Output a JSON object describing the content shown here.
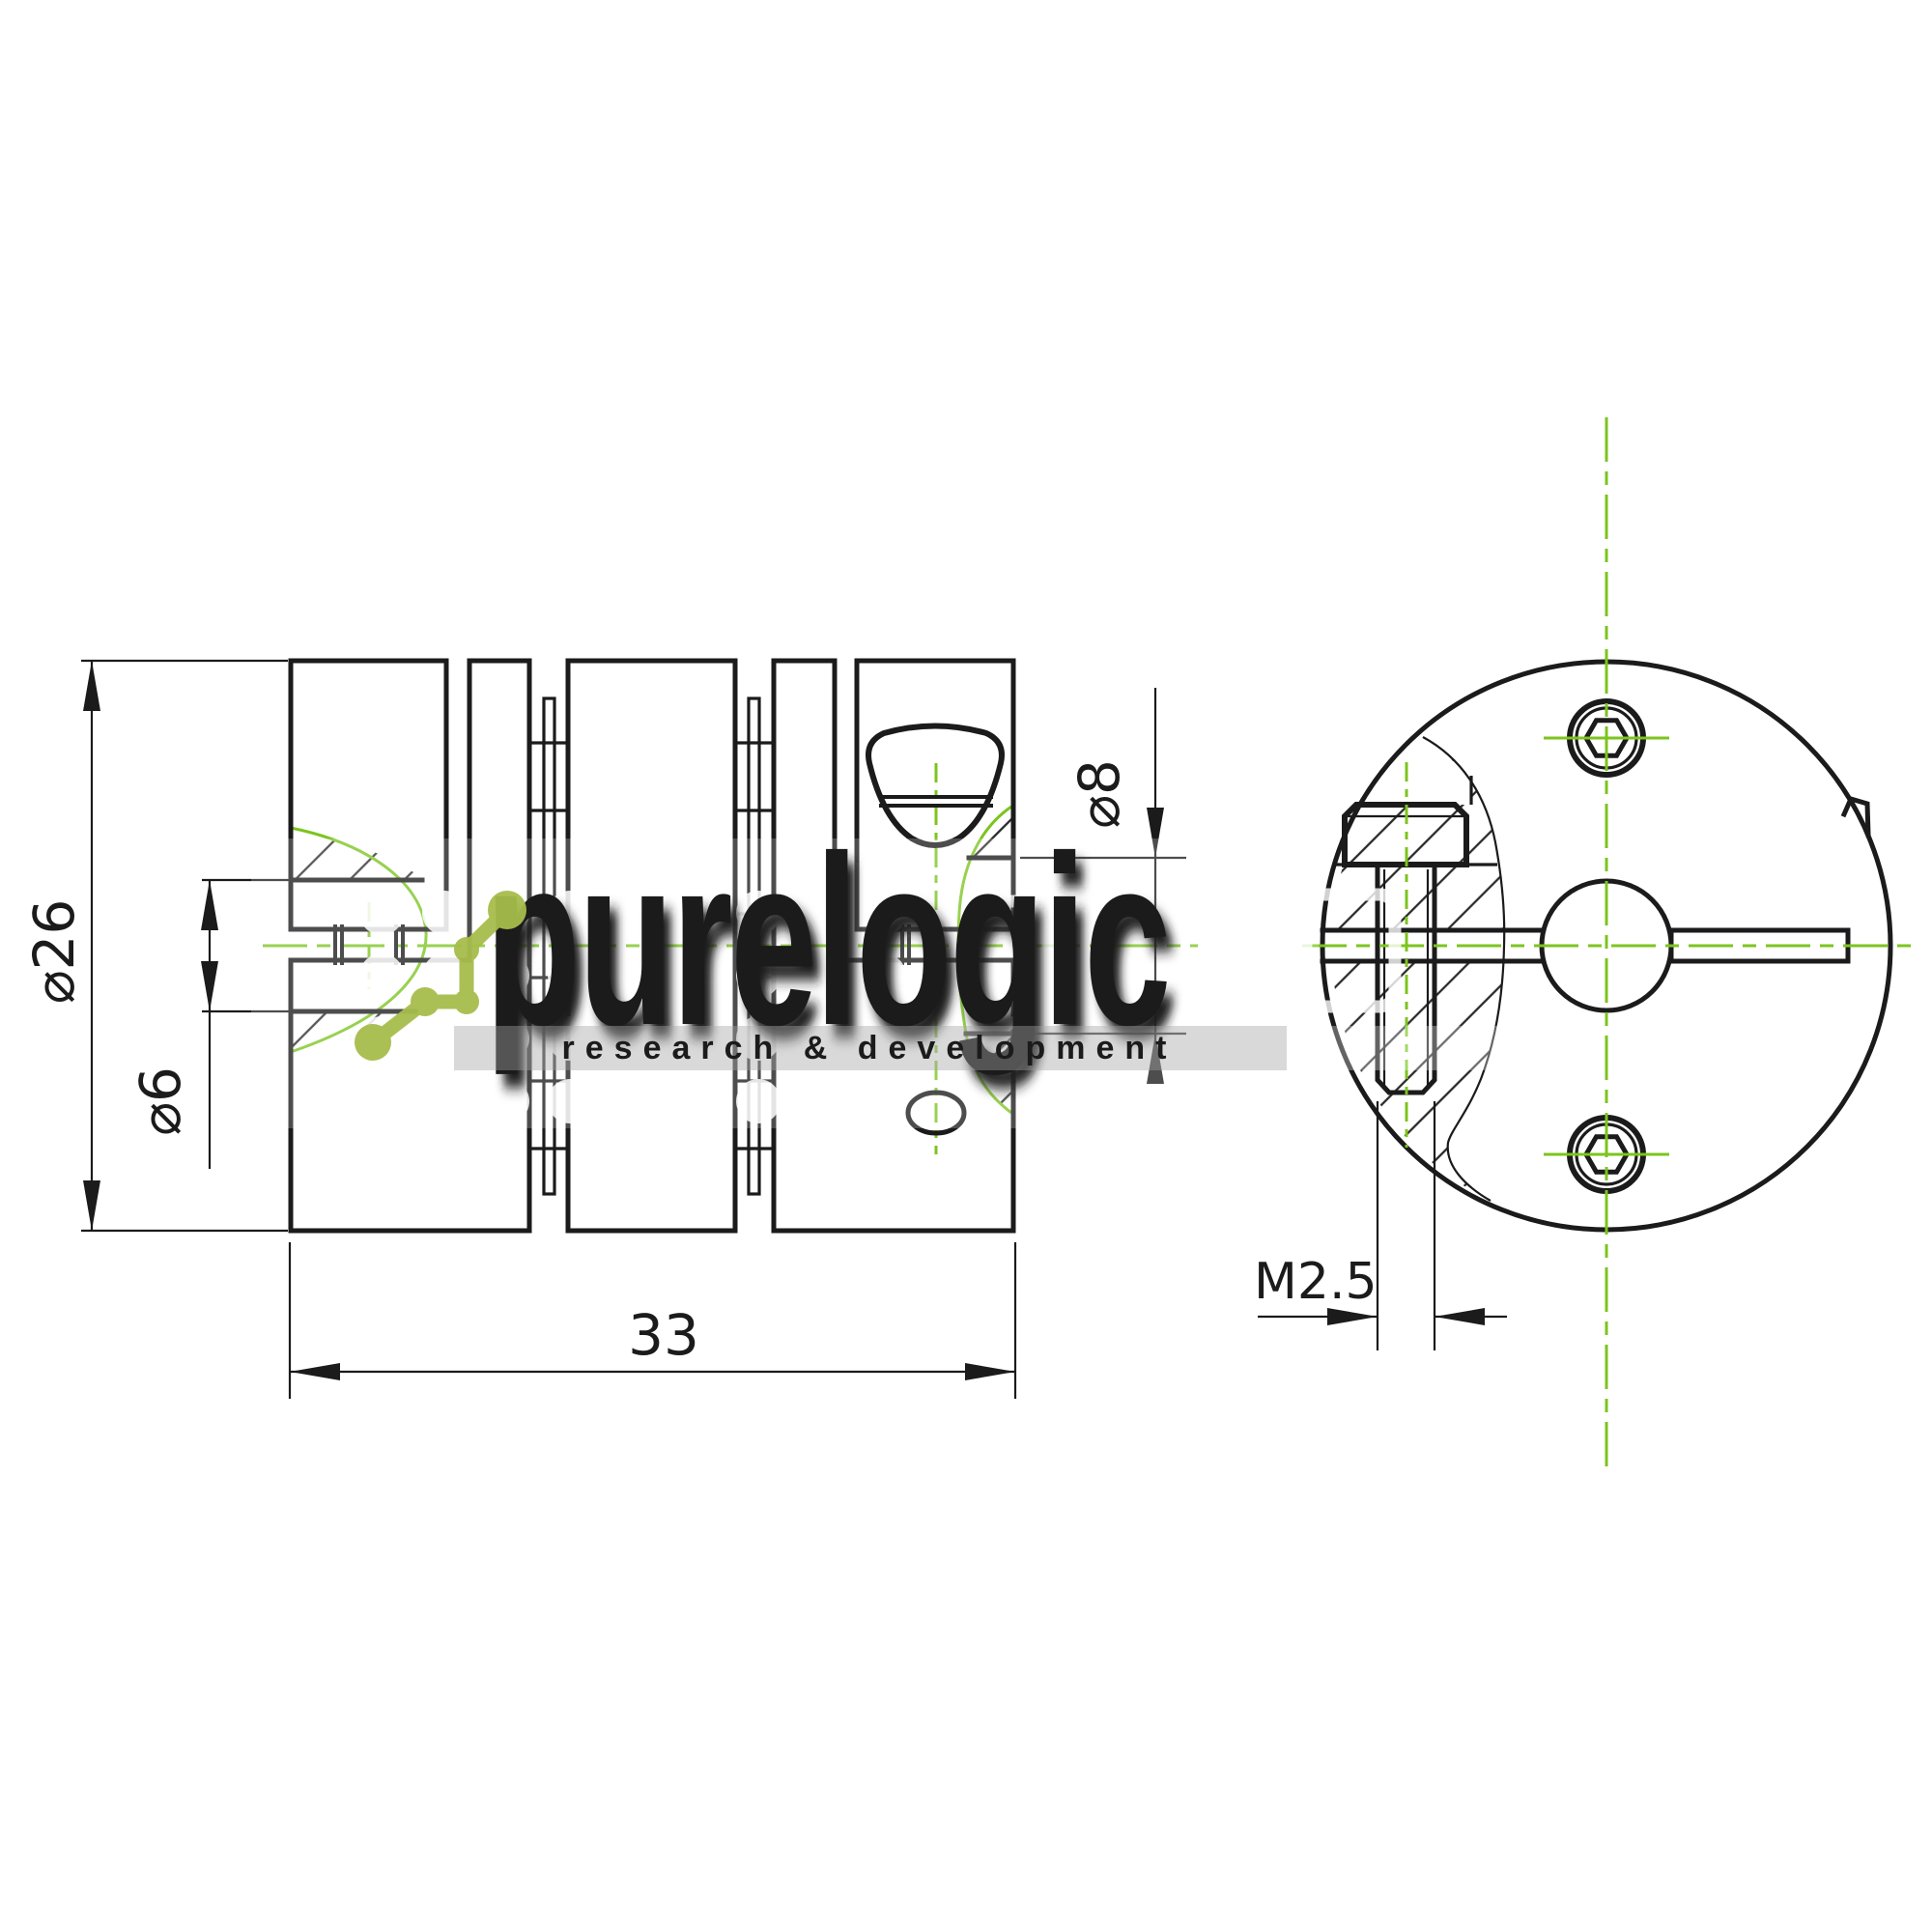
{
  "dimensions": {
    "outer_diameter": "⌀26",
    "bore_left": "⌀6",
    "bore_right": "⌀8",
    "overall_length": "33",
    "clamp_screw_thread": "M2.5"
  },
  "watermark": {
    "brand": "purelogic",
    "tagline": "research & development"
  },
  "colors": {
    "line": "#1b1b1b",
    "centerline_green": "#7cc41f",
    "logo_green": "#a6bd4b",
    "background": "#ffffff"
  }
}
